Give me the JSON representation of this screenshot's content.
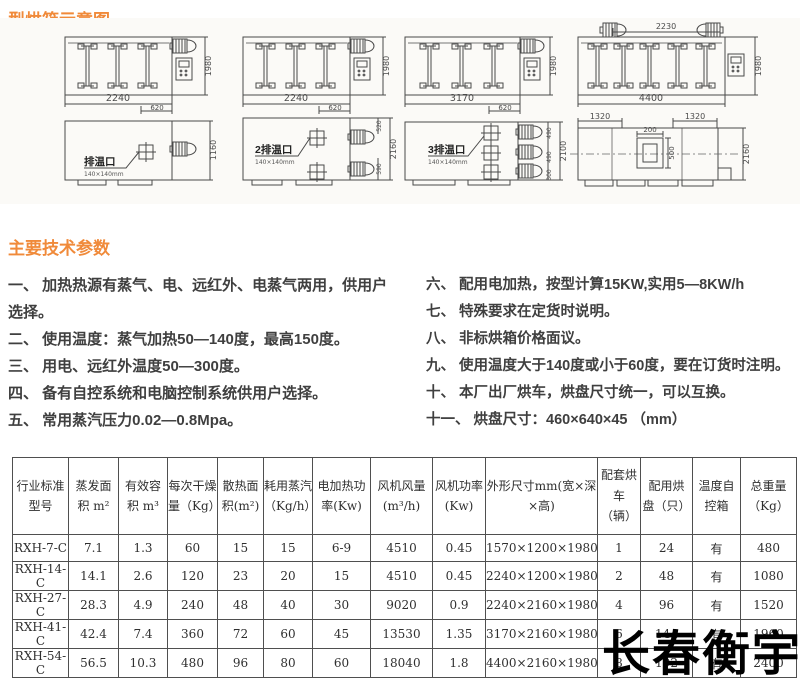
{
  "page": {
    "title": "型烘箱示意图",
    "params_title": "主要技术参数",
    "watermark": "长春衡宇"
  },
  "diagrams": {
    "row1": [
      {
        "width": "2240",
        "offset": "620",
        "height": "1980"
      },
      {
        "width": "2240",
        "offset": "620",
        "height": "1980"
      },
      {
        "width": "3170",
        "offset": "620",
        "height": "1980"
      },
      {
        "width": "4400",
        "top_span": "2230",
        "height": "1980"
      }
    ],
    "row2": [
      {
        "label": "排温口",
        "vent_size": "140×140mm",
        "height": "1160"
      },
      {
        "label": "2排温口",
        "vent_size": "140×140mm",
        "seg_top": "520",
        "seg_bottom": "590",
        "height": "2160"
      },
      {
        "label": "3排温口",
        "vent_size": "140×140mm",
        "seg1": "490",
        "seg2": "490",
        "seg3": "300",
        "height": "2100"
      },
      {
        "left_span": "1320",
        "right_span": "1320",
        "port_width": "200",
        "port_height": "500",
        "height": "2160"
      }
    ]
  },
  "specs": {
    "left": [
      "一、 加热热源有蒸气、电、远红外、电蒸气两用，供用户\n选择。",
      "二、 使用温度：蒸气加热50—140度，最高150度。",
      "三、 用电、远红外温度50—300度。",
      "四、 备有自控系统和电脑控制系统供用户选择。",
      "五、 常用蒸汽压力0.02—0.8Mpa。"
    ],
    "right": [
      "六、 配用电加热，按型计算15KW,实用5—8KW/h",
      "七、 特殊要求在定货时说明。",
      "八、 非标烘箱价格面议。",
      "九、 使用温度大于140度或小于60度，要在订货时注明。",
      "十、 本厂出厂烘车，烘盘尺寸统一，可以互换。",
      "十一、 烘盘尺寸：460×640×45 （mm）"
    ]
  },
  "table": {
    "headers": [
      "行业标准\n型号",
      "蒸发面\n积 m²",
      "有效容\n积 m³",
      "每次干燥\n量（Kg）",
      "散热面\n积(m²)",
      "耗用蒸汽\n（Kg/h）",
      "电加热功\n率(Kw)",
      "风机风量\n(m³/h)",
      "风机功率\n(Kw)",
      "外形尺寸mm(宽×深\n×高)",
      "配套烘\n车（辆）",
      "配用烘\n盘（只）",
      "温度自\n控箱",
      "总重量\n（Kg）"
    ],
    "rows": [
      [
        "RXH-7-C",
        "7.1",
        "1.3",
        "60",
        "15",
        "15",
        "6-9",
        "4510",
        "0.45",
        "1570×1200×1980",
        "1",
        "24",
        "有",
        "480"
      ],
      [
        "RXH-14-C",
        "14.1",
        "2.6",
        "120",
        "23",
        "20",
        "15",
        "4510",
        "0.45",
        "2240×1200×1980",
        "2",
        "48",
        "有",
        "1080"
      ],
      [
        "RXH-27-C",
        "28.3",
        "4.9",
        "240",
        "48",
        "40",
        "30",
        "9020",
        "0.9",
        "2240×2160×1980",
        "4",
        "96",
        "有",
        "1520"
      ],
      [
        "RXH-41-C",
        "42.4",
        "7.4",
        "360",
        "72",
        "60",
        "45",
        "13530",
        "1.35",
        "3170×2160×1980",
        "6",
        "144",
        "有",
        "1960"
      ],
      [
        "RXH-54-C",
        "56.5",
        "10.3",
        "480",
        "96",
        "80",
        "60",
        "18040",
        "1.8",
        "4400×2160×1980",
        "8",
        "192",
        "有",
        "2400"
      ]
    ]
  }
}
